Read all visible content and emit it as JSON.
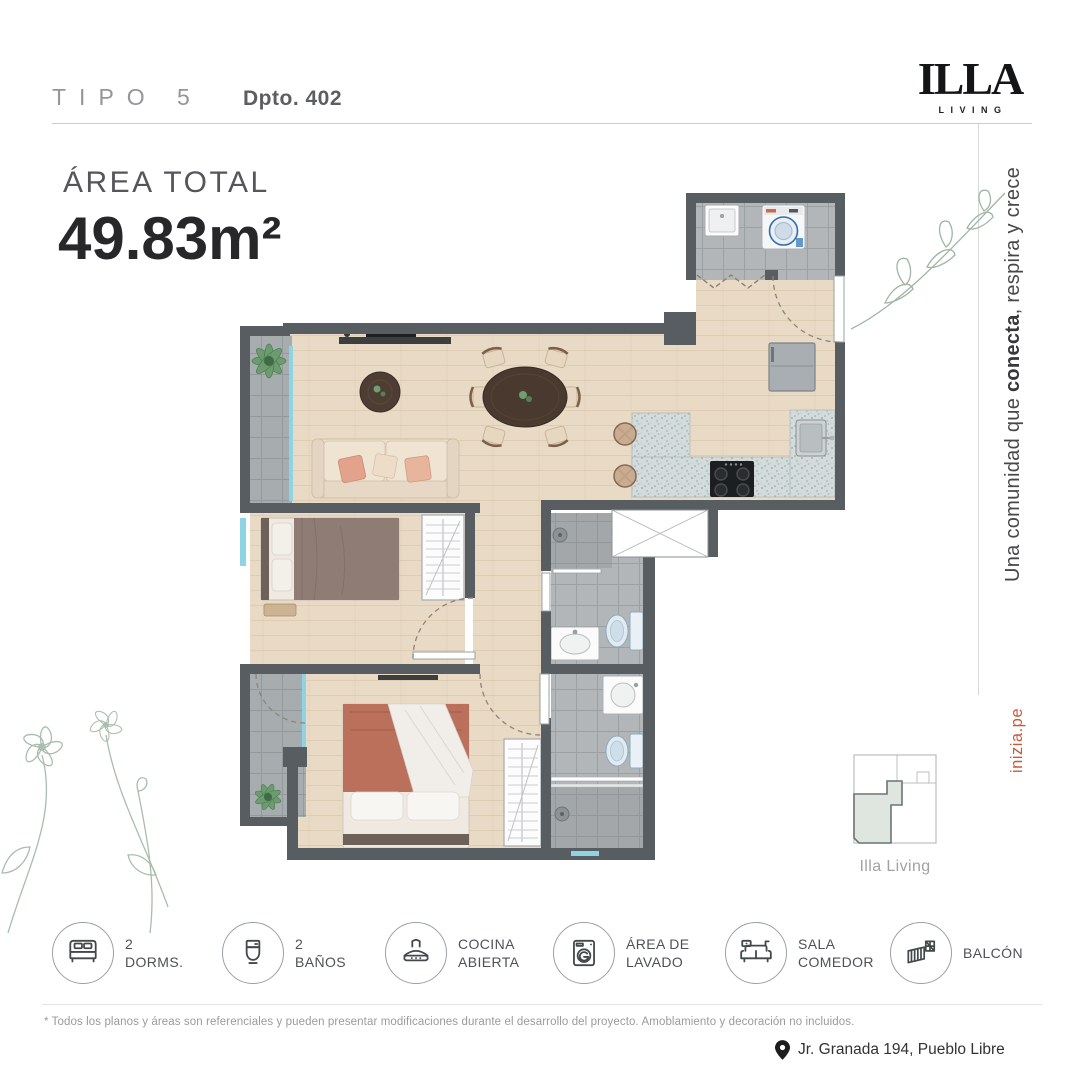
{
  "header": {
    "type_label": "TIPO 5",
    "unit_label": "Dpto. 402"
  },
  "logo": {
    "name": "ILLA",
    "subtitle": "LIVING"
  },
  "area": {
    "label": "ÁREA TOTAL",
    "value": "49.83m²"
  },
  "tagline": {
    "part1": "Una comunidad que ",
    "highlight": "conecta",
    "part2": ", respira y crece"
  },
  "website": "inizia.pe",
  "minimap": {
    "label": "Illa Living"
  },
  "features": [
    {
      "icon": "bed-icon",
      "line1": "2",
      "line2": "DORMS."
    },
    {
      "icon": "toilet-icon",
      "line1": "2",
      "line2": "BAÑOS"
    },
    {
      "icon": "kitchen-hood-icon",
      "line1": "COCINA",
      "line2": "ABIERTA"
    },
    {
      "icon": "washing-machine-icon",
      "line1": "ÁREA DE",
      "line2": "LAVADO"
    },
    {
      "icon": "sofa-icon",
      "line1": "SALA",
      "line2": "COMEDOR"
    },
    {
      "icon": "balcony-icon",
      "line1": "BALCÓN",
      "line2": ""
    }
  ],
  "disclaimer": "* Todos los planos y áreas son referenciales y pueden presentar modificaciones durante el desarrollo del proyecto. Amoblamiento y decoración no incluidos.",
  "address": "Jr. Granada 194, Pueblo Libre",
  "colors": {
    "accent": "#c75a3c",
    "wall": "#585d61",
    "unit_highlight": "#dfe6df"
  }
}
